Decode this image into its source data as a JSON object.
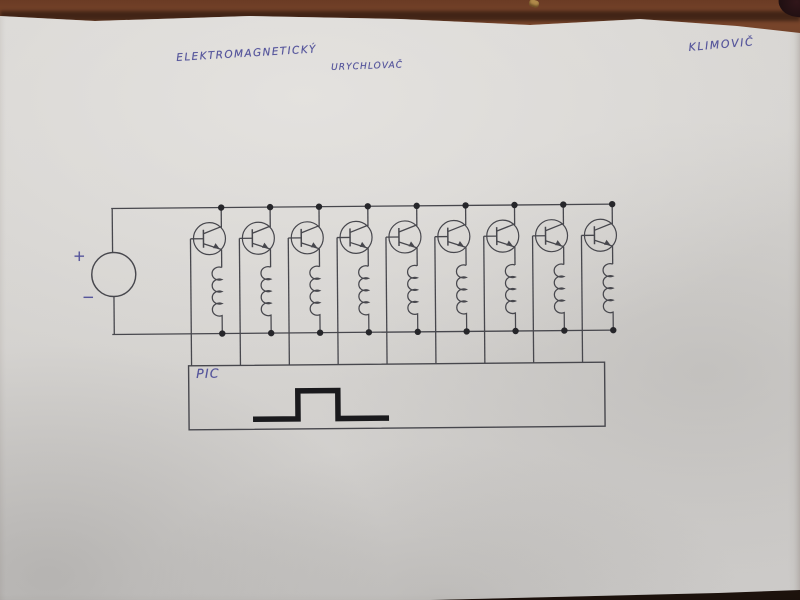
{
  "title": {
    "line1": "ELEKTROMAGNETICKÝ",
    "line2": "URYCHLOVAČ"
  },
  "author": "KLIMOVIČ",
  "labels": {
    "pic": "PIC",
    "plus": "+",
    "minus": "−"
  },
  "colors": {
    "ink_blue": "#4b4b97",
    "pencil": "#47474d",
    "junction_dot": "#26262a",
    "pulse_black": "#1a1a1d",
    "desk_wood": "#6f4027",
    "paper": "#d5d3d0"
  },
  "schematic": {
    "type": "circuit-schematic",
    "description": "Hand-drawn electromagnetic accelerator (coilgun) schematic: a DC source feeds two horizontal supply rails; nine identical stages each consist of an NPN transistor whose collector ties to the top rail and whose emitter drives a coil returning to the bottom rail; each transistor base is wired down to a PIC controller box that outputs a square trigger pulse.",
    "stage_count": 9,
    "components": [
      {
        "name": "dc-source",
        "symbol": "circle",
        "terminals": [
          "+",
          "−"
        ]
      },
      {
        "name": "driver-stage",
        "count": 9,
        "parts": [
          "npn-transistor",
          "coil"
        ]
      },
      {
        "name": "controller",
        "label": "PIC",
        "output": "square-pulse"
      }
    ],
    "pulse_points": "252,418 297,418 297,390 337,390 337,418 388,418"
  }
}
